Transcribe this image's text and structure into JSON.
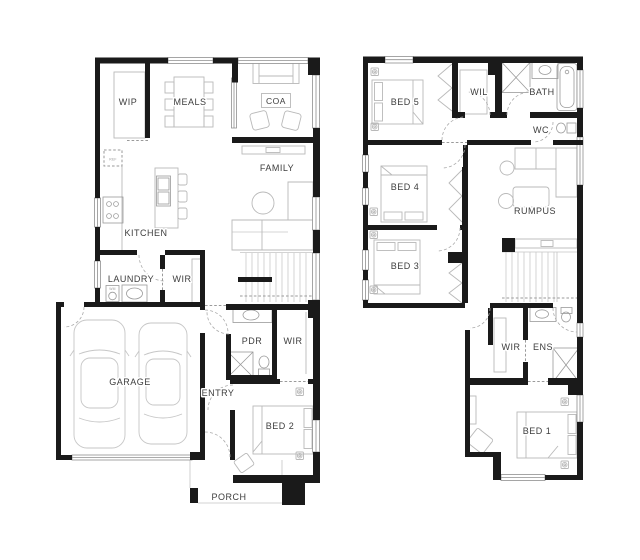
{
  "page": {
    "background": "#ffffff"
  },
  "colors": {
    "background": "#ffffff",
    "wall": "#1a1a1a",
    "furniture": "#b9b9b9",
    "fixture": "#9a9a9a",
    "door": "#ababab",
    "window": "#8f8f8f",
    "tread": "#c9c9c9",
    "car": "#c6c6c6",
    "label": "#3d3d3d"
  },
  "ground_floor": {
    "rooms": {
      "wip": "WIP",
      "meals": "MEALS",
      "coa": "COA",
      "family": "FAMILY",
      "kitchen": "KITCHEN",
      "laundry": "LAUNDRY",
      "wir_laundry": "WIR",
      "garage": "GARAGE",
      "pdr": "PDR",
      "wir_bed2": "WIR",
      "entry": "ENTRY",
      "bed2": "BED 2",
      "porch": "PORCH"
    },
    "appliances": {
      "fridge": "REF",
      "washer": "WM"
    }
  },
  "first_floor": {
    "rooms": {
      "bed5": "BED 5",
      "wil": "WIL",
      "bath": "BATH",
      "wc": "WC",
      "bed4": "BED 4",
      "rumpus": "RUMPUS",
      "bed3": "BED 3",
      "wir": "WIR",
      "ens": "ENS",
      "bed1": "BED 1"
    }
  }
}
